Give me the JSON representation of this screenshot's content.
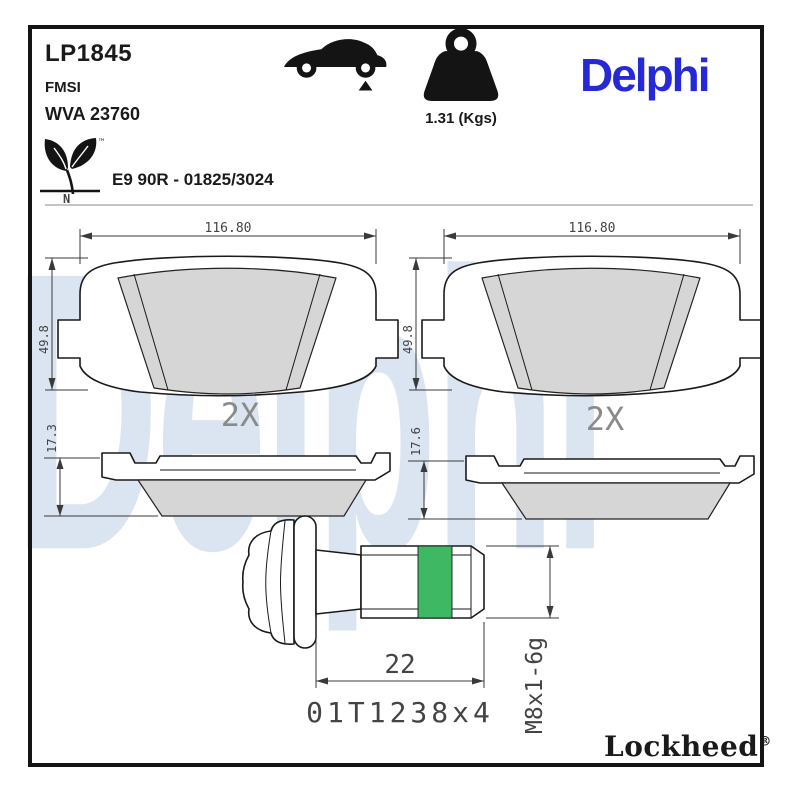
{
  "header": {
    "part_number": "LP1845",
    "fmsi_label": "FMSI",
    "wva_number": "WVA 23760",
    "weight_value": "1.31 (Kgs)",
    "brand_logo": "Delphi",
    "homologation": "E9 90R - 01825/3024",
    "eco_tm": "™",
    "eco_n": "N"
  },
  "drawings": {
    "pads": [
      {
        "width_dim": "116.80",
        "height_dim": "49.8",
        "qty_label": "2X",
        "thickness_dim": "17.3"
      },
      {
        "width_dim": "116.80",
        "height_dim": "49.8",
        "qty_label": "2X",
        "thickness_dim": "17.6"
      }
    ],
    "bolt": {
      "length_dim": "22",
      "thread_spec": "M8x1-6g",
      "marking_ref": "01T1238x4"
    },
    "watermark": "Delphi",
    "footer_brand": "Lockheed",
    "footer_registered": "®"
  },
  "colors": {
    "brand_blue": "#2629d8",
    "watermark_blue": "#dbe4f1",
    "pad_gray": "#d6d6d6",
    "thread_lock_green": "#3eb863",
    "frame_black": "#141414"
  }
}
